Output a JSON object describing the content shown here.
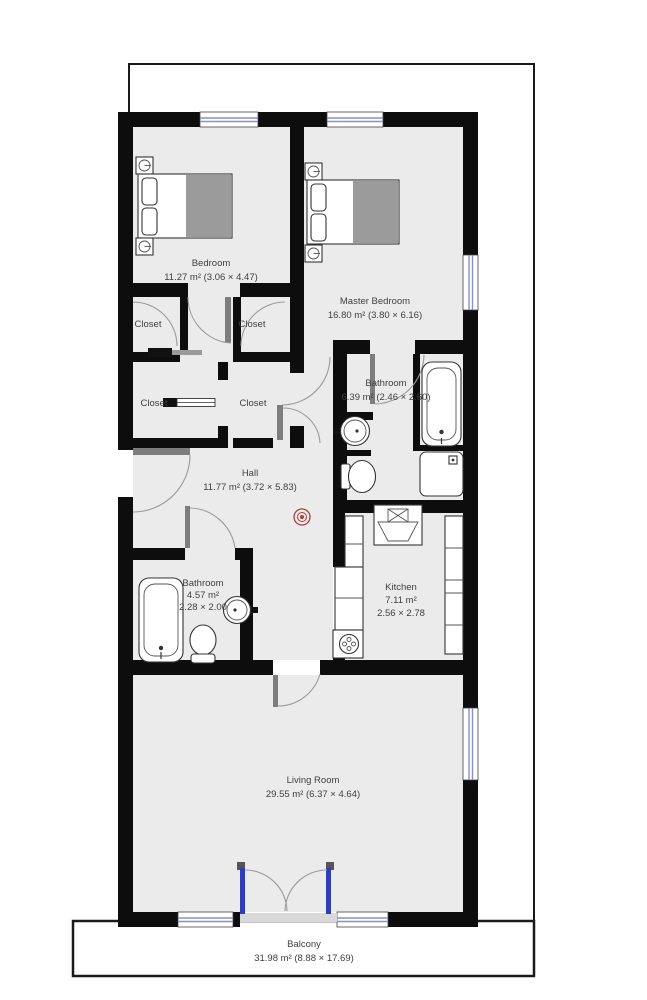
{
  "plan": {
    "title": "Apartment floor plan",
    "rooms": {
      "bedroom": {
        "name": "Bedroom",
        "area": "11.27 m² (3.06 × 4.47)"
      },
      "master_bedroom": {
        "name": "Master Bedroom",
        "area": "16.80 m² (3.80 × 6.16)"
      },
      "bathroom_master": {
        "name": "Bathroom",
        "area": "6.39 m² (2.46 × 2.60)"
      },
      "hall": {
        "name": "Hall",
        "area": "11.77 m² (3.72 × 5.83)"
      },
      "bathroom": {
        "name": "Bathroom",
        "area": "4.57 m²",
        "dims": "2.28 × 2.00"
      },
      "kitchen": {
        "name": "Kitchen",
        "area": "7.11 m²",
        "dims": "2.56 × 2.78"
      },
      "living_room": {
        "name": "Living Room",
        "area": "29.55 m² (6.37 × 4.64)"
      },
      "balcony": {
        "name": "Balcony",
        "area": "31.98 m² (8.88 × 17.69)"
      }
    },
    "closet": {
      "label": "Closet",
      "count": 4
    },
    "icons": {
      "smoke_detector": "concentric-red-circles",
      "bed": "double-bed-with-pillows-and-blanket",
      "nightstand": "square-with-lamp-circle",
      "bathtub": "rounded-tub-with-drain",
      "shower": "square-shower-tray",
      "sink": "round-basin-with-tap",
      "toilet": "toilet-bowl-with-tank",
      "stove": "burner-circle",
      "window": "double-blue-line-in-wall",
      "french_door": "double-swing-blue-panels"
    },
    "colors": {
      "wall": "#0d0d0d",
      "floor": "#ebebeb",
      "window_line": "#8792c4",
      "door_panel": "#2f3db8",
      "detector": "#b23b3b",
      "label_text": "#3f3f3f"
    }
  }
}
